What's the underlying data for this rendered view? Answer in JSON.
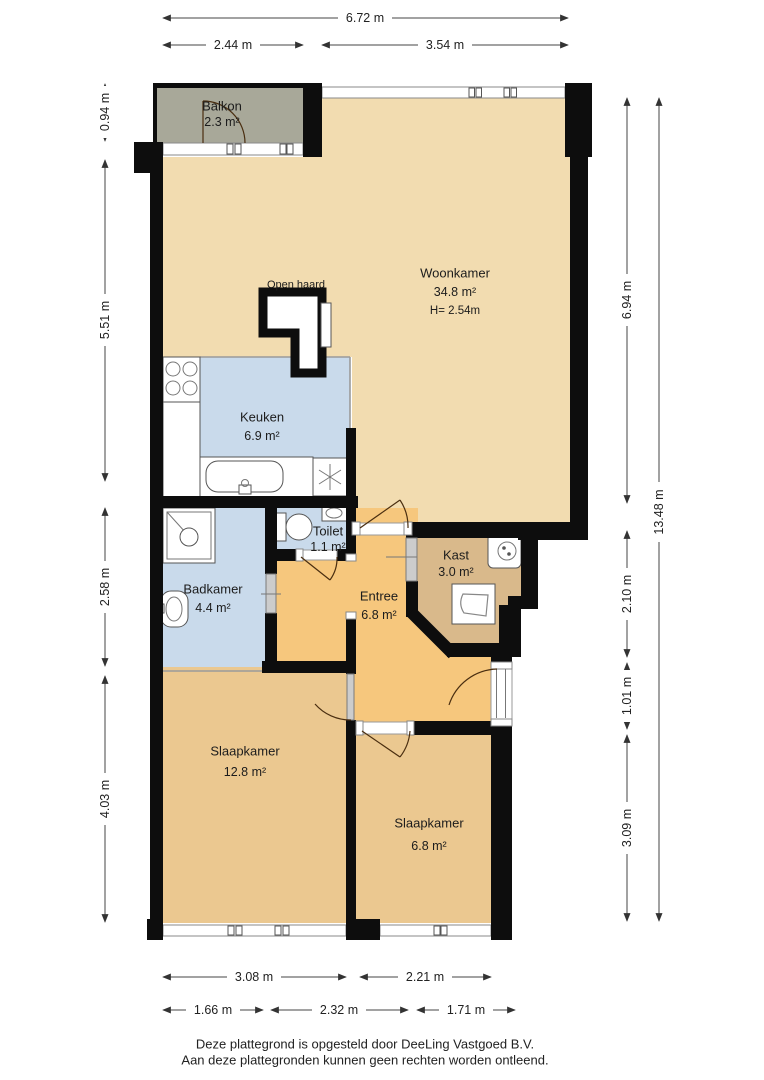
{
  "title": "Plattegrond appartement",
  "rooms": {
    "balkon": {
      "name": "Balkon",
      "area": "2.3 m²"
    },
    "woonkamer": {
      "name": "Woonkamer",
      "area": "34.8 m²",
      "height": "H= 2.54m"
    },
    "open_haard": {
      "name": "Open haard"
    },
    "keuken": {
      "name": "Keuken",
      "area": "6.9 m²"
    },
    "toilet": {
      "name": "Toilet",
      "area": "1.1 m²"
    },
    "badkamer": {
      "name": "Badkamer",
      "area": "4.4 m²"
    },
    "entree": {
      "name": "Entree",
      "area": "6.8 m²"
    },
    "kast": {
      "name": "Kast",
      "area": "3.0 m²"
    },
    "slaapkamer1": {
      "name": "Slaapkamer",
      "area": "12.8 m²"
    },
    "slaapkamer2": {
      "name": "Slaapkamer",
      "area": "6.8 m²"
    }
  },
  "dimensions": {
    "top": {
      "total": "6.72 m",
      "left": "2.44 m",
      "right": "3.54 m"
    },
    "left": {
      "balkon": "0.94 m",
      "upper": "5.51 m",
      "middle": "2.58 m",
      "lower": "4.03 m"
    },
    "right": {
      "upper": "6.94 m",
      "total": "13.48 m",
      "kast": "2.10 m",
      "hall": "1.01 m",
      "lower": "3.09 m"
    },
    "bottom": {
      "room1": "3.08 m",
      "room2": "2.21 m",
      "sub1": "1.66 m",
      "sub2": "2.32 m",
      "sub3": "1.71 m"
    }
  },
  "footer": {
    "line1": "Deze plattegrond is opgesteld door DeeLing Vastgoed B.V.",
    "line2": "Aan deze plattegronden kunnen geen rechten worden ontleend."
  },
  "colors": {
    "wall": "#0d0d0d",
    "woonkamer": "#f2dcb0",
    "keuken": "#c9daeb",
    "badkamer": "#c9daeb",
    "toilet": "#c9daeb",
    "entree": "#f6c77d",
    "kast": "#d9b98b",
    "slaapkamer": "#ebc890",
    "balkon": "#a8a899"
  }
}
